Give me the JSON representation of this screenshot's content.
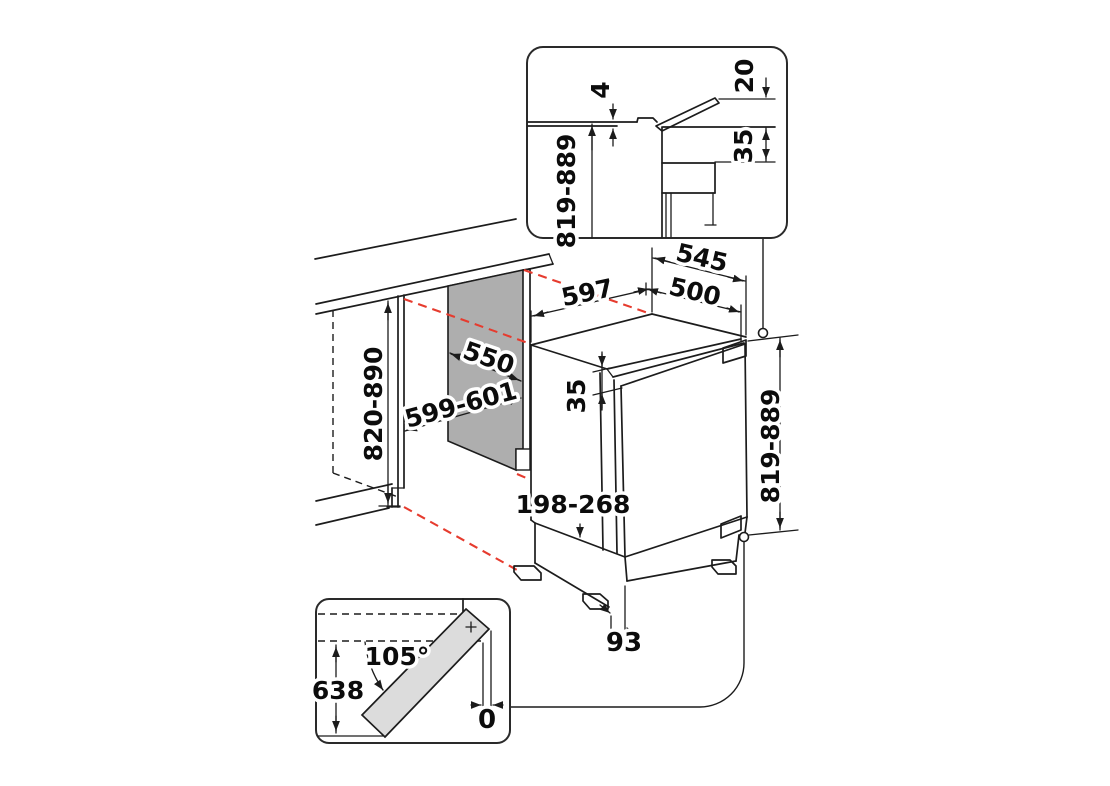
{
  "colors": {
    "line": "#1c1c1c",
    "red_dashed": "#e63b2e",
    "niche_panel": "#aeaeae",
    "door_fill": "#dcdcdc"
  },
  "top_inset": {
    "gap": "4",
    "edge_clearance": "20",
    "top_recess": "35",
    "build_height": "819-889"
  },
  "main": {
    "depth_total": "545",
    "depth_body": "500",
    "width": "597",
    "niche_depth": "550",
    "niche_width": "599-601",
    "niche_height": "820-890",
    "door_top_recess": "35",
    "height": "819-889",
    "plinth_height": "198-268",
    "foot_setback": "93"
  },
  "door_inset": {
    "opening_angle": "105°",
    "swing_depth": "638",
    "side_clearance": "0"
  }
}
